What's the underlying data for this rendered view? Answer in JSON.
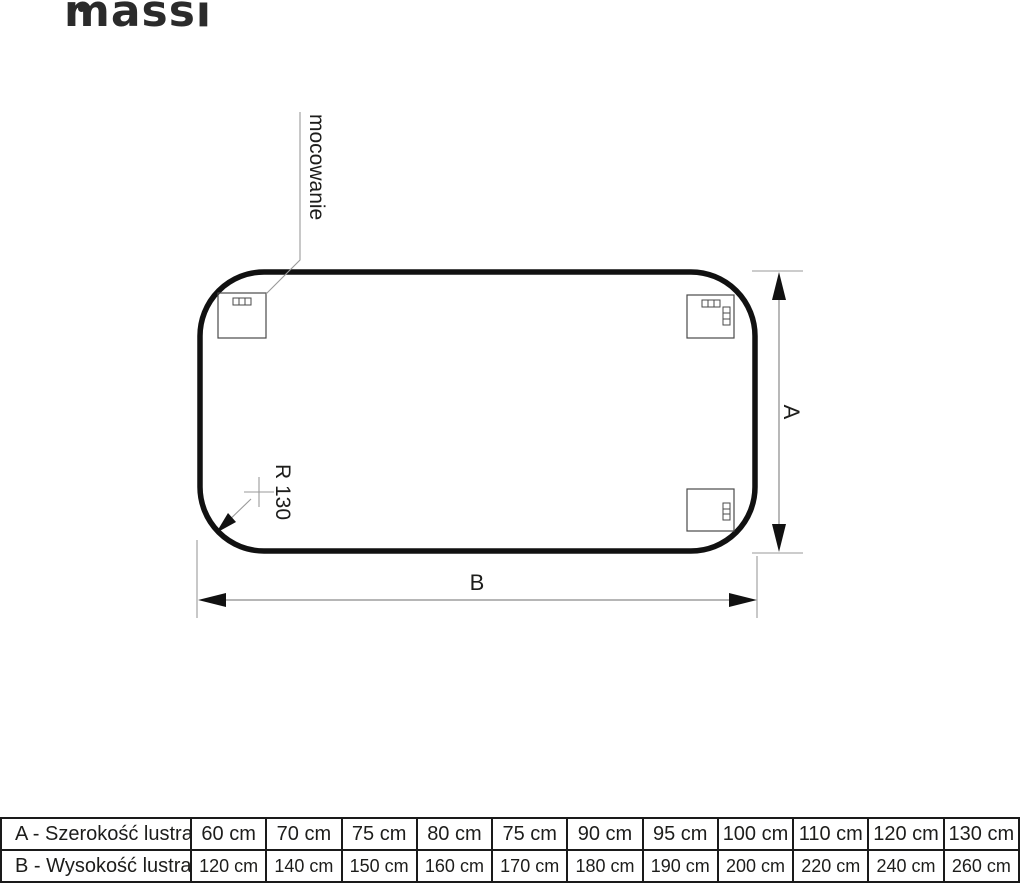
{
  "brand": {
    "logo_text": "massi"
  },
  "diagram": {
    "mounting_label": "mocowanie",
    "radius_label": "R 130",
    "dim_vertical_label": "A",
    "dim_horizontal_label": "B"
  },
  "table": {
    "rows": [
      {
        "label": "A - Szerokość lustra",
        "values": [
          "60 cm",
          "70 cm",
          "75 cm",
          "80 cm",
          "75 cm",
          "90 cm",
          "95 cm",
          "100 cm",
          "110 cm",
          "120 cm",
          "130 cm"
        ]
      },
      {
        "label": "B - Wysokość lustra",
        "values": [
          "120 cm",
          "140 cm",
          "150 cm",
          "160 cm",
          "170 cm",
          "180 cm",
          "190 cm",
          "200 cm",
          "220 cm",
          "240 cm",
          "260 cm"
        ]
      }
    ]
  },
  "colors": {
    "outline": "#111111",
    "thin_line": "#9a9a9a",
    "text": "#1d1d1b",
    "table_border": "#1a1a1a"
  }
}
